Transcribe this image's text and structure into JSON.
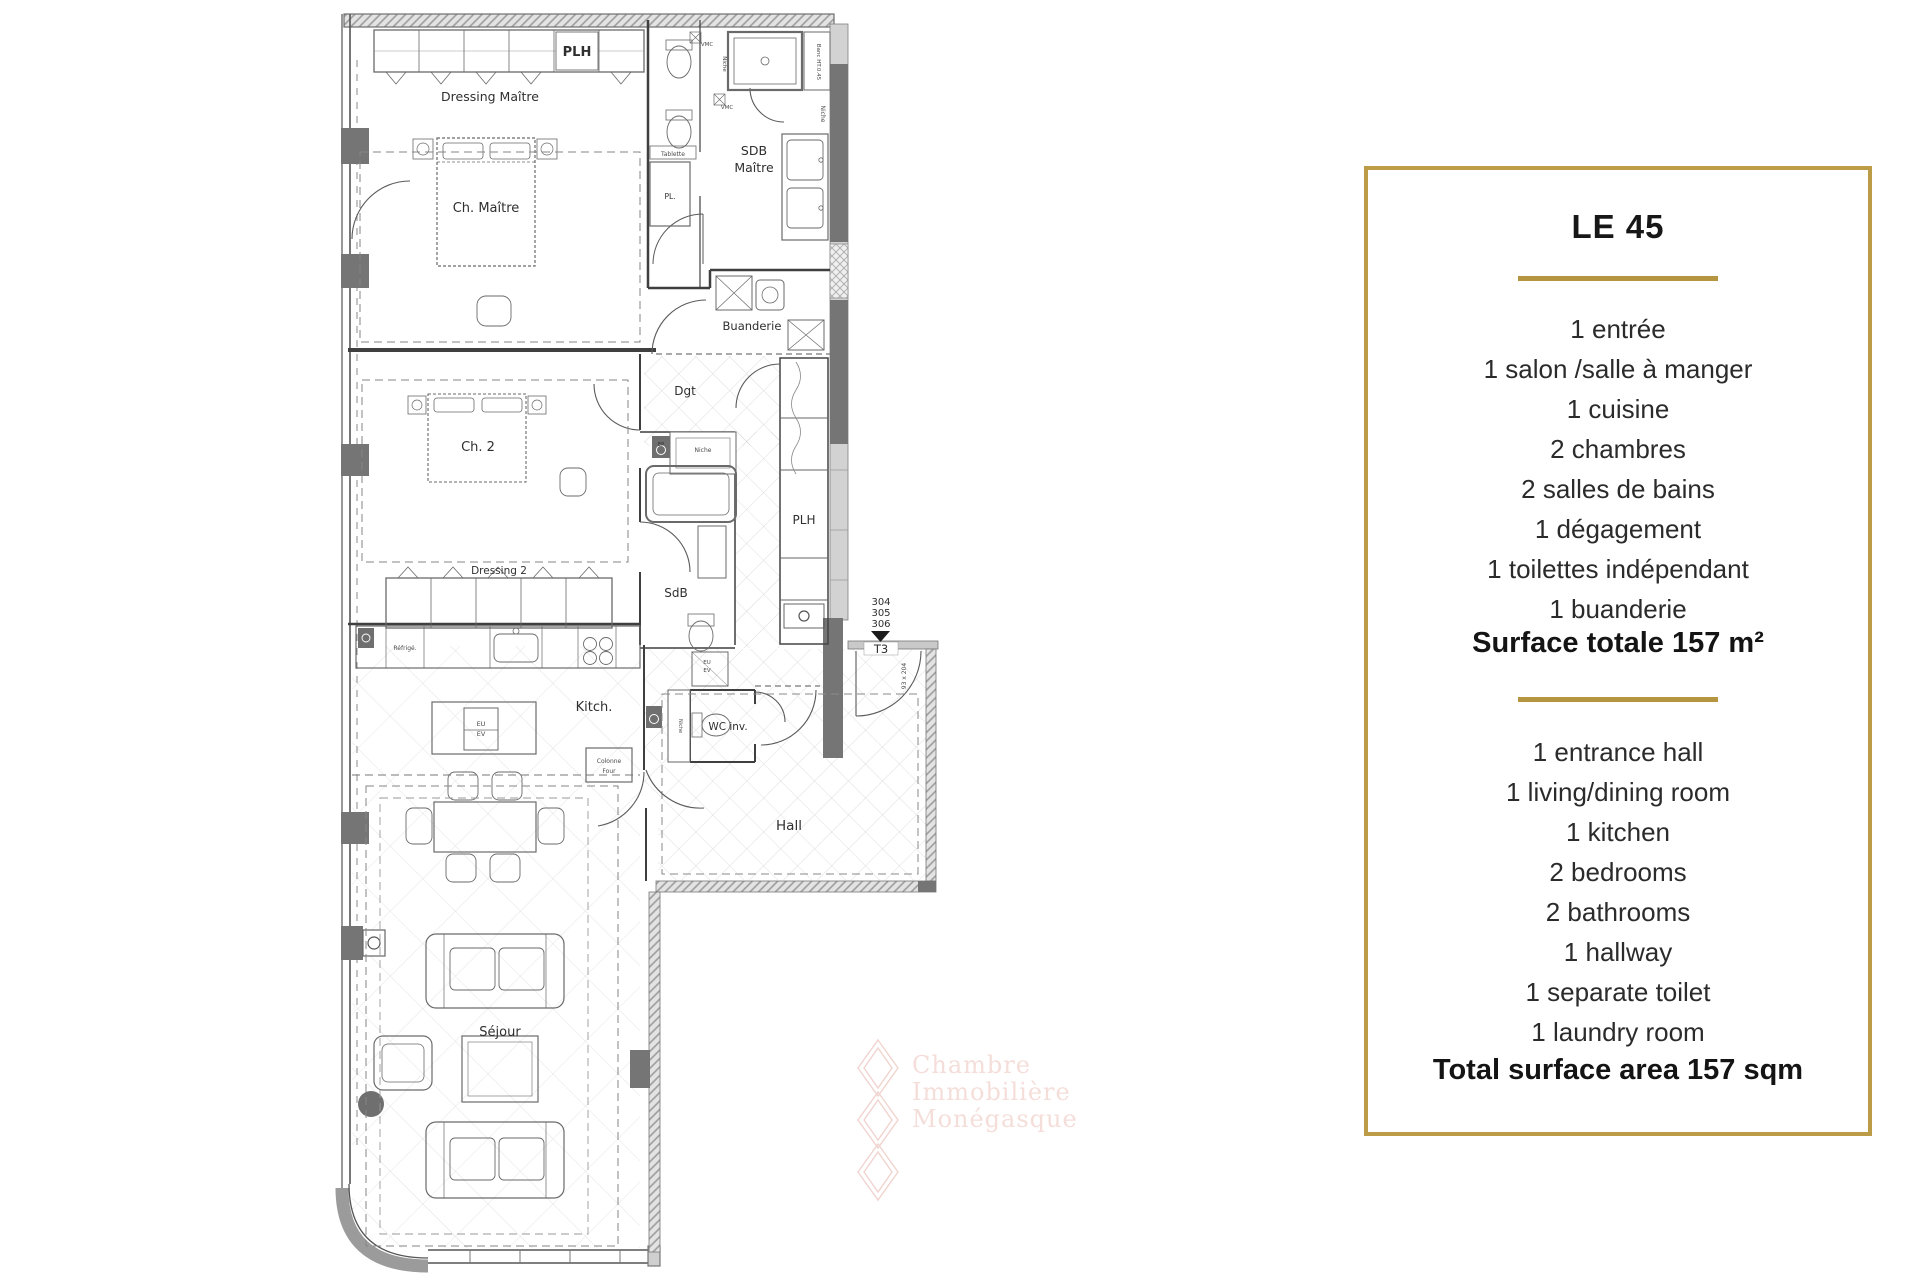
{
  "panel": {
    "title": "LE 45",
    "items_fr": [
      "1 entrée",
      "1 salon /salle à manger",
      "1 cuisine",
      "2 chambres",
      "2 salles de bains",
      "1 dégagement",
      "1 toilettes indépendant",
      "1 buanderie"
    ],
    "surface_fr": "Surface totale 157 m²",
    "items_en": [
      "1 entrance hall",
      "1 living/dining room",
      "1 kitchen",
      "2 bedrooms",
      "2 bathrooms",
      "1 hallway",
      "1 separate toilet",
      "1 laundry room"
    ],
    "surface_en": "Total surface area 157 sqm",
    "accent_color": "#b5953f"
  },
  "plan": {
    "rooms": {
      "plh_top": "PLH",
      "dressing_maitre": "Dressing Maître",
      "ch_maitre": "Ch. Maître",
      "sdb_maitre": [
        "SDB",
        "Maître"
      ],
      "vmc": "VMC",
      "tablette": "Tablette",
      "pl": "PL.",
      "banc": "Banc HT.0.45",
      "niche": "Niche",
      "buanderie": "Buanderie",
      "dgt": "Dgt",
      "ch2": "Ch. 2",
      "ep": "EP",
      "plh_right": "PLH",
      "dressing2": "Dressing 2",
      "sdb": "SdB",
      "refrige": "Réfrigé.",
      "kitch": "Kitch.",
      "colonne_four": [
        "Colonne",
        "Four"
      ],
      "eu_ev": [
        "EU",
        "EV"
      ],
      "wc_inv": "WC inv.",
      "hall": "Hall",
      "sejour": "Séjour"
    },
    "unit_numbers": [
      "304",
      "305",
      "306"
    ],
    "unit_type": "T3",
    "door_size": "93 x 204",
    "watermark": [
      "Chambre",
      "Immobilière",
      "Monégasque"
    ]
  }
}
